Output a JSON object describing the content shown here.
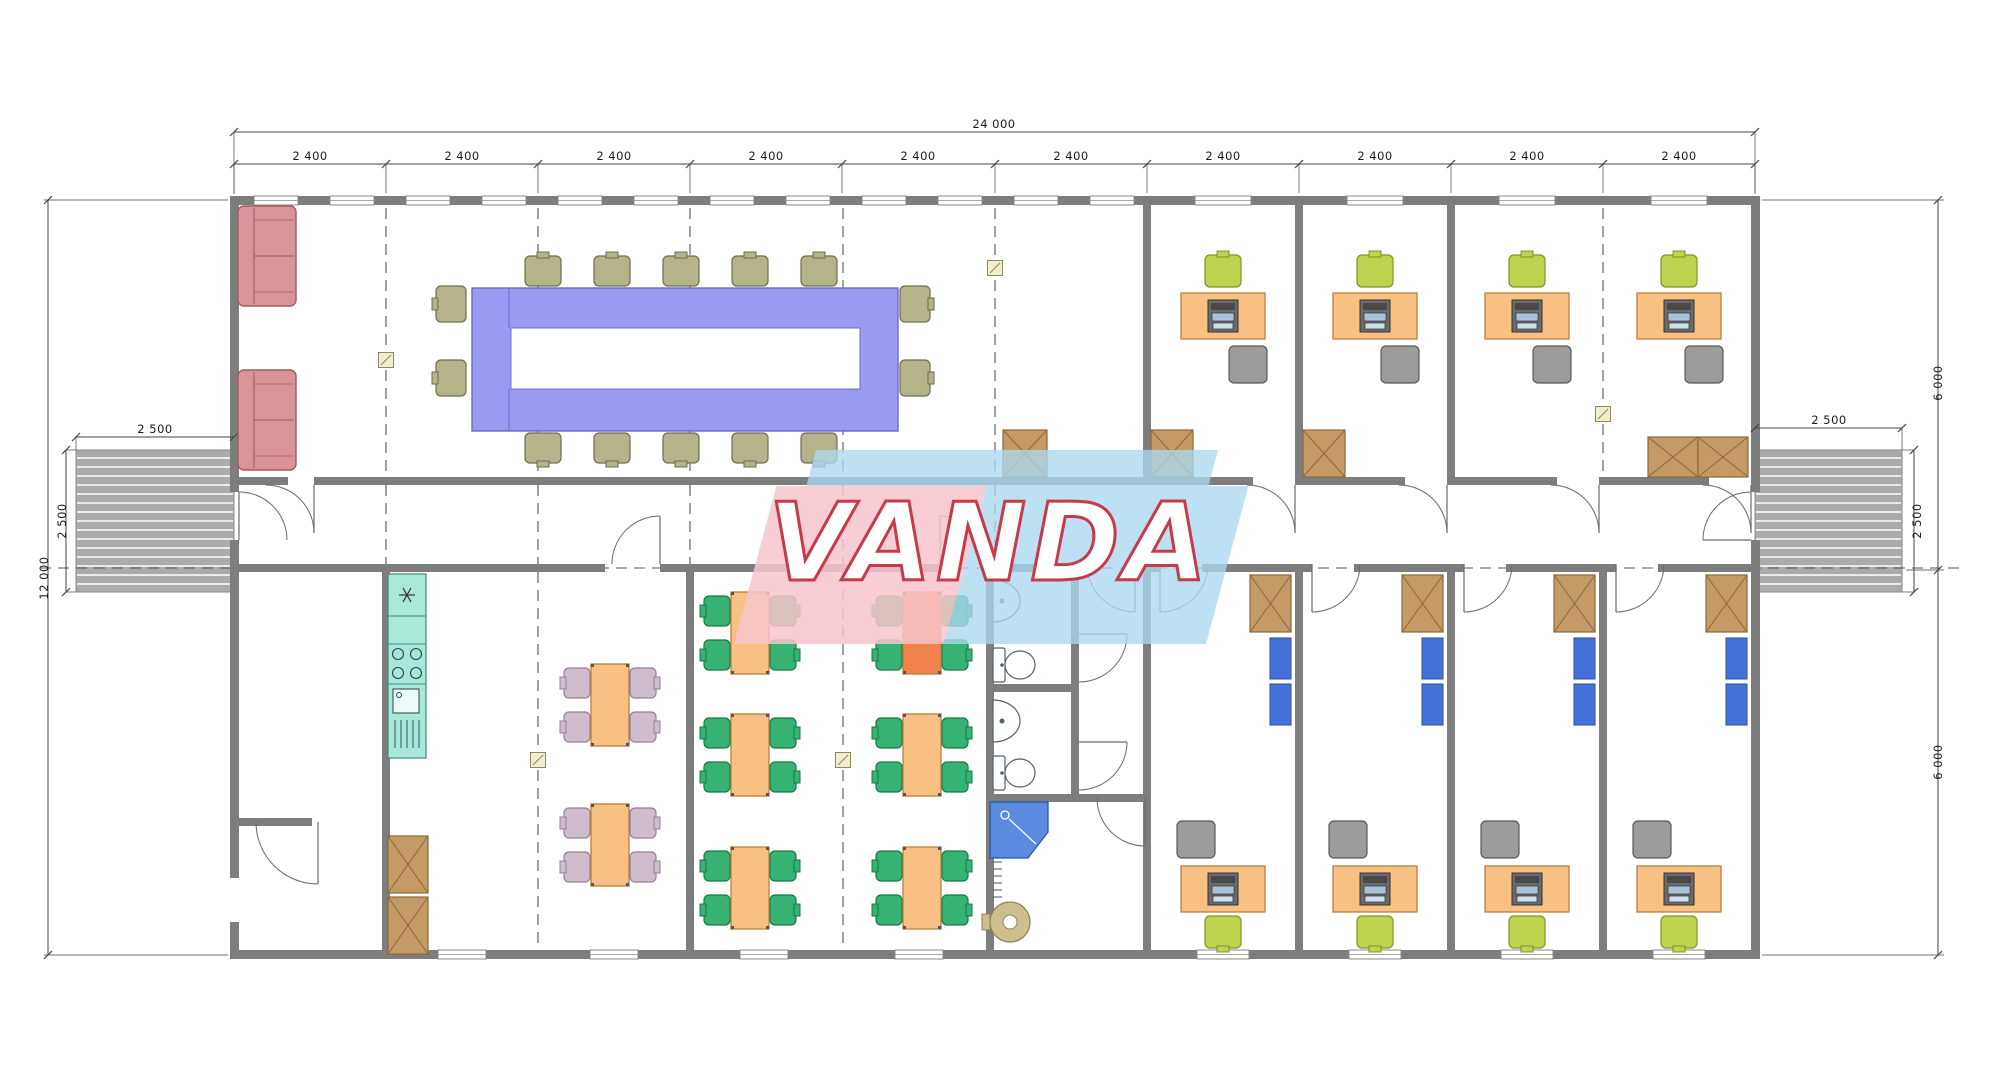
{
  "palette": {
    "wall": "#7d7d7d",
    "dim_line": "#444444",
    "grid_dash": "#555555",
    "ramp": "#ababab",
    "ramp_stripe": "#ffffff",
    "conf_table": "#9a9af0",
    "conf_table_border": "#6d6dc8",
    "chair_olive": "#b4b38a",
    "chair_olive_border": "#6e6e52",
    "sofa": "#d9949a",
    "sofa_border": "#a05a60",
    "desk": "#f9c083",
    "desk_border": "#b9803c",
    "chair_green": "#bcd44f",
    "chair_green_border": "#7e9420",
    "chair_gray": "#9c9c9c",
    "chair_gray_border": "#5a5a5a",
    "cafe_table": "#f9c083",
    "cafe_table_hl": "#f0824d",
    "cafe_chair": "#35b274",
    "cafe_chair_border": "#177a46",
    "dine_chair": "#cfbccd",
    "dine_chair_border": "#93809a",
    "kitchen": "#a7e8d8",
    "kitchen_border": "#44897e",
    "box_brown": "#c49a66",
    "box_brown_border": "#8a6a3a",
    "cab_blue": "#4472d8",
    "cab_blue_border": "#2b4ea0",
    "shower": "#5b8be0",
    "shower_border": "#2d57a8",
    "boiler": "#cdc08d",
    "boiler_border": "#8f855a",
    "fixture": "#ffffff",
    "fixture_border": "#556070",
    "marker_fill": "#f2edd0",
    "marker_border": "#8a8a5a",
    "door_arc": "#6a6a6a",
    "window_frame": "#888888",
    "wm_blue": "rgba(171,217,239,0.78)",
    "wm_pink": "rgba(247,198,205,0.85)",
    "wm_text": "#ffffff",
    "wm_text_outline": "#c63a4a"
  },
  "dimensions": {
    "overall_width": "24 000",
    "bays": [
      "2 400",
      "2 400",
      "2 400",
      "2 400",
      "2 400",
      "2 400",
      "2 400",
      "2 400",
      "2 400",
      "2 400"
    ],
    "overall_height": "12 000",
    "left_ramp_width": "2 500",
    "left_ramp_depth": "2 500",
    "right_ramp_width": "2 500",
    "right_ramp_depth": "2 500",
    "right_upper_section": "6 000",
    "right_lower_section": "6 000"
  },
  "watermark": {
    "text": "VANDA"
  },
  "furniture": {
    "conference": {
      "sofas": [
        [
          238,
          206
        ],
        [
          238,
          370
        ]
      ],
      "table": [
        472,
        288,
        426,
        143
      ],
      "table_hole": [
        511,
        328,
        349,
        61
      ],
      "chair_row_xs": [
        543,
        612,
        681,
        750,
        819
      ],
      "chair_top_y": 256,
      "chair_bottom_y": 433,
      "side_chair_ys": [
        304,
        378
      ],
      "left_chair_x": 436,
      "right_chair_x": 900,
      "storage_box": [
        1003,
        430,
        44,
        47
      ]
    },
    "offices_top": {
      "desk_centers": [
        1223,
        1375,
        1527,
        1679
      ],
      "desk_y": 293,
      "boxes": [
        [
          1151,
          430,
          42,
          47
        ],
        [
          1303,
          430,
          42,
          47
        ],
        [
          1648,
          437,
          100,
          40
        ]
      ]
    },
    "offices_bottom": {
      "desk_centers": [
        1223,
        1375,
        1527,
        1679
      ],
      "desk_y": 866,
      "boxes": [
        [
          1250,
          575,
          41,
          57
        ],
        [
          1402,
          575,
          41,
          57
        ],
        [
          1554,
          575,
          41,
          57
        ],
        [
          1706,
          575,
          41,
          57
        ]
      ],
      "blue_cabinets": [
        [
          1270,
          638
        ],
        [
          1422,
          638
        ],
        [
          1574,
          638
        ],
        [
          1726,
          638
        ]
      ]
    },
    "dining": {
      "tables": [
        [
          610,
          705
        ],
        [
          610,
          845
        ]
      ],
      "boxes": [
        [
          388,
          836,
          40,
          57
        ],
        [
          388,
          897,
          40,
          57
        ]
      ],
      "kitchen": {
        "x": 388,
        "y": 574,
        "w": 38,
        "fridge_h": 42,
        "counter_h": 28,
        "stove_h": 40,
        "sink_h": 74
      }
    },
    "cafeteria": {
      "tables": [
        [
          750,
          633
        ],
        [
          922,
          633
        ],
        [
          750,
          755
        ],
        [
          922,
          755
        ],
        [
          750,
          888
        ],
        [
          922,
          888
        ]
      ],
      "highlight_index": 1
    },
    "bathroom": {
      "sinks": [
        [
          993,
          580
        ],
        [
          993,
          700
        ]
      ],
      "toilets": [
        [
          993,
          648
        ],
        [
          993,
          756
        ]
      ],
      "shower": [
        990,
        802,
        58,
        56
      ],
      "boiler": [
        1010,
        922,
        20
      ],
      "radiator": [
        993,
        862,
        6
      ]
    },
    "grid_markers": [
      [
        386,
        360
      ],
      [
        538,
        360
      ],
      [
        690,
        360
      ],
      [
        843,
        360
      ],
      [
        995,
        268
      ],
      [
        843,
        518
      ],
      [
        1603,
        414
      ],
      [
        538,
        760
      ],
      [
        843,
        760
      ]
    ]
  }
}
